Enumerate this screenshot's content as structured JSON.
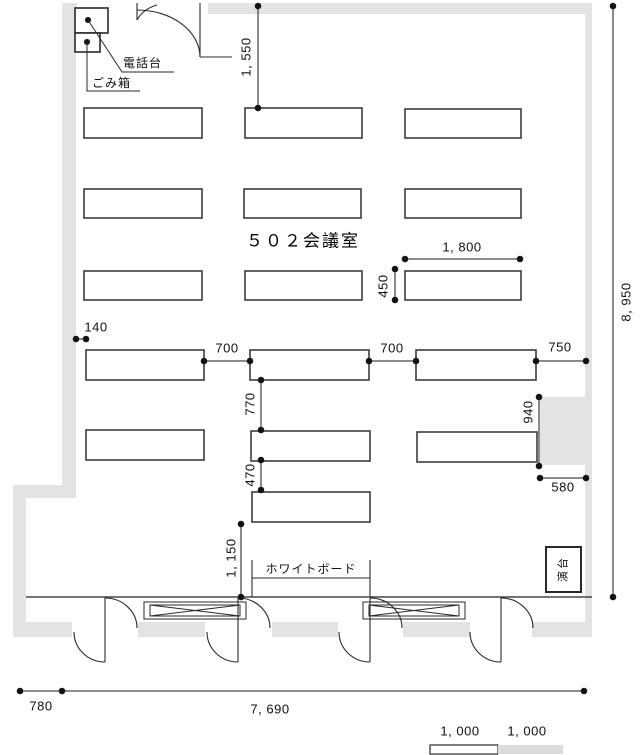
{
  "title": {
    "room_label": "５０２会議室"
  },
  "fixtures": {
    "phone_stand": "電話台",
    "trash_bin": "ごみ箱",
    "whiteboard": "ホワイトボード",
    "podium": "演台"
  },
  "dimensions": {
    "entry_offset": "1, 550",
    "room_depth": "8, 950",
    "table_length": "1, 800",
    "table_depth": "450",
    "left_offset": "140",
    "aisle_left": "700",
    "aisle_right": "700",
    "right_offset": "750",
    "row_gap_upper": "770",
    "row_gap_lower": "470",
    "pillar_depth": "940",
    "pillar_width": "580",
    "front_clearance": "1, 150",
    "entrance_width": "780",
    "room_width": "7, 690",
    "scale_segment_1": "1, 000",
    "scale_segment_2": "1, 000"
  },
  "colors": {
    "wall_fill": "#e3e3e3",
    "line_stroke": "#222222",
    "table_stroke": "#3c3c3c",
    "scale_gray": "#dcdcdc"
  }
}
